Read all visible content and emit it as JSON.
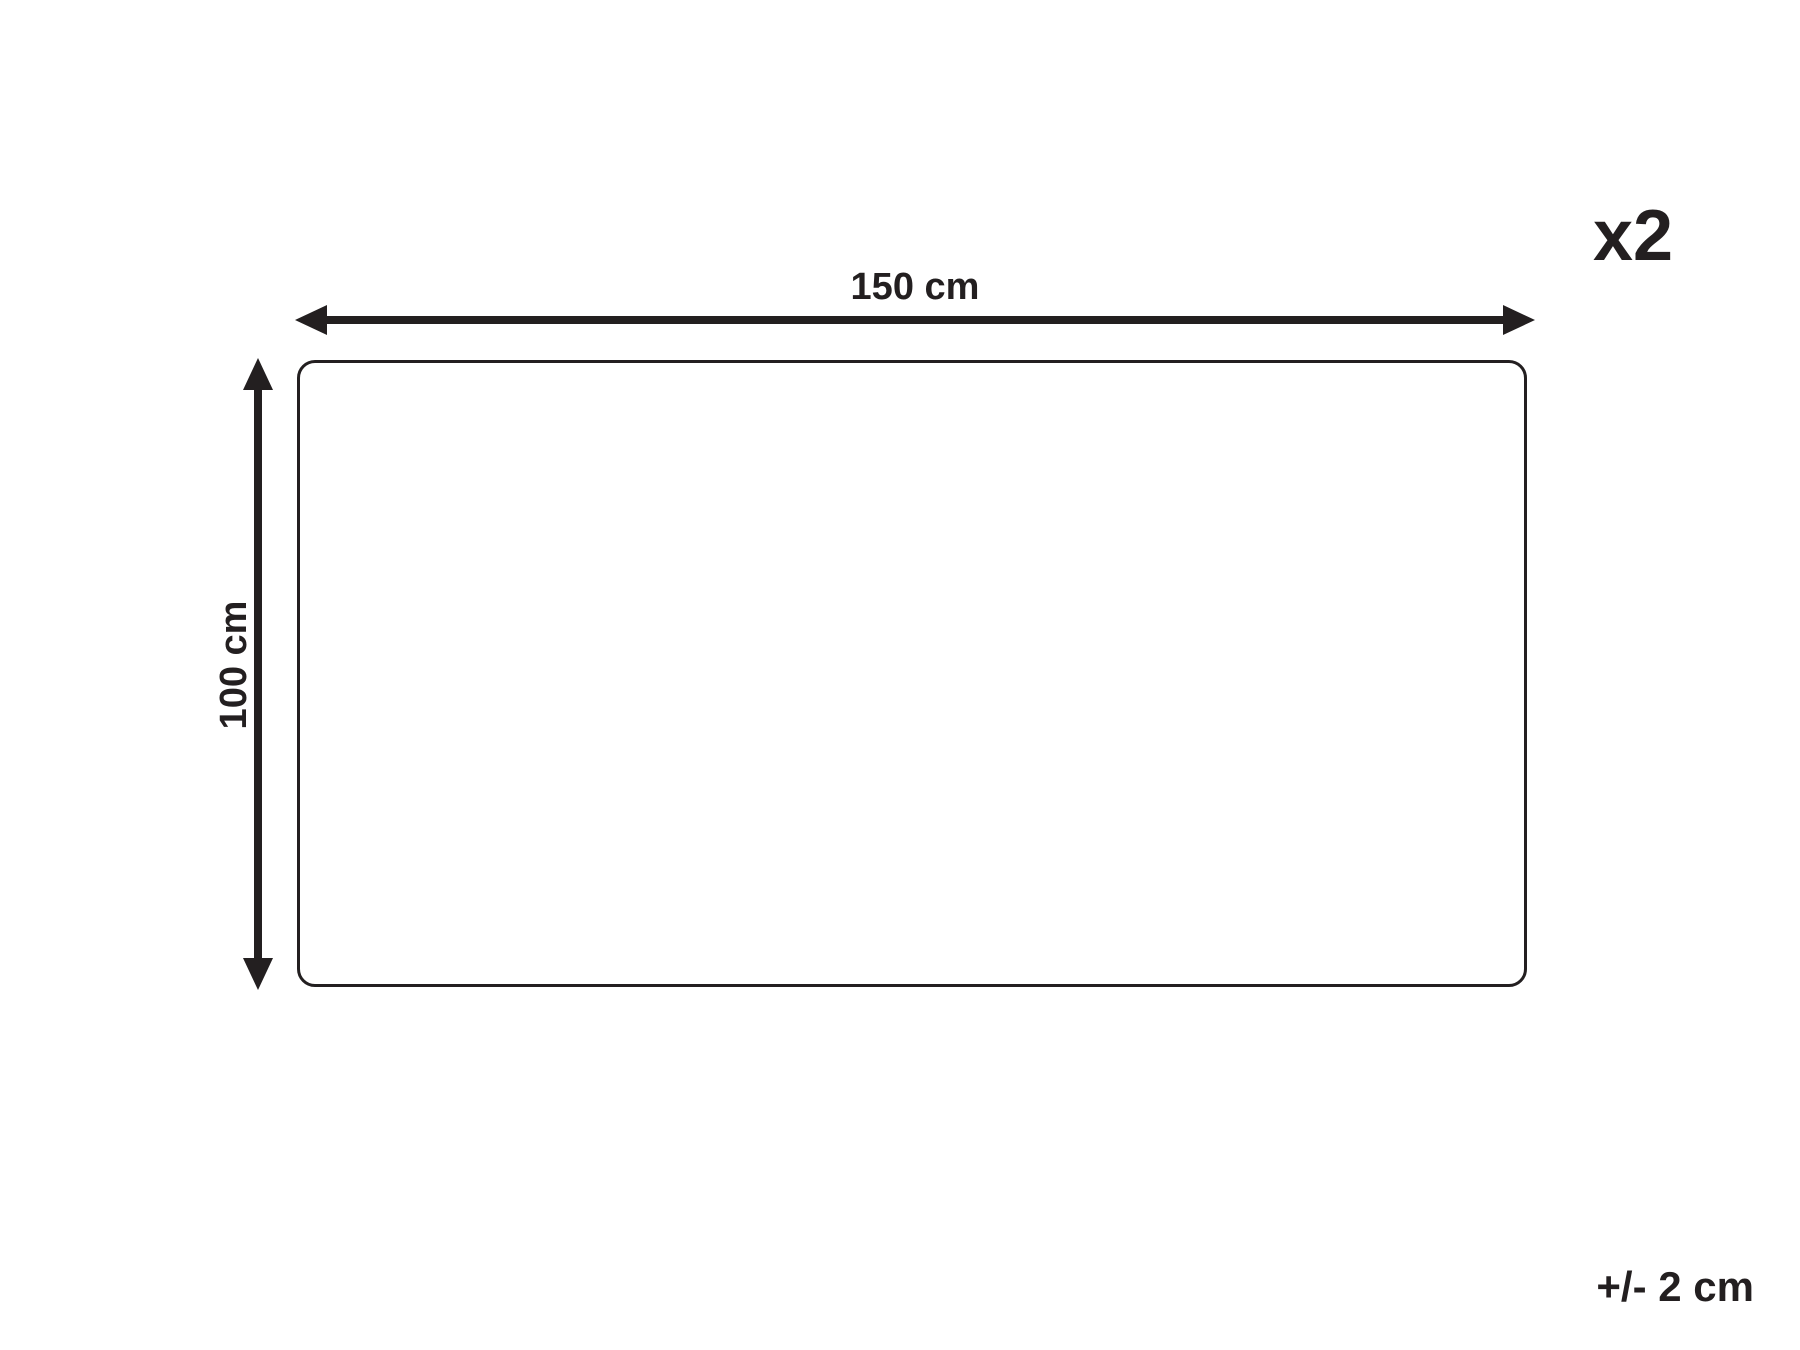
{
  "diagram": {
    "quantity_label": "x2",
    "width_label": "150 cm",
    "height_label": "100 cm",
    "tolerance_label": "+/- 2 cm",
    "line_color": "#231f20",
    "background_color": "#ffffff",
    "dimensions": {
      "width_cm": 150,
      "height_cm": 100,
      "quantity": 2,
      "tolerance_cm": 2
    }
  }
}
